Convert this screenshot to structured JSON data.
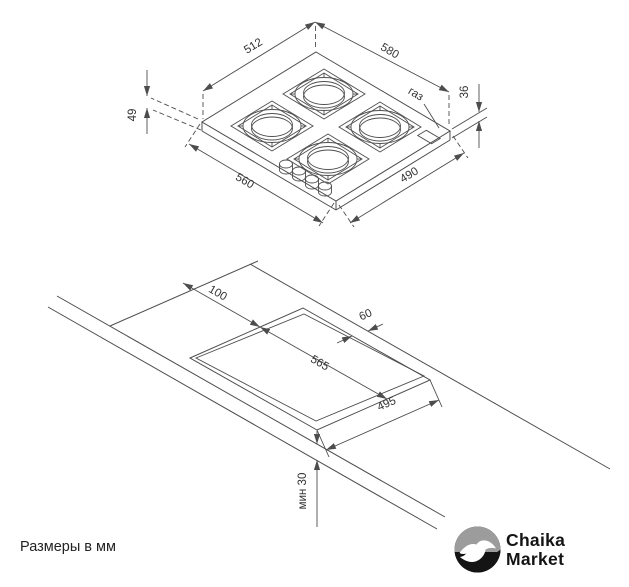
{
  "colors": {
    "background": "#ffffff",
    "line": "#4d4d4d",
    "text": "#333333",
    "logo_ink": "#141414",
    "logo_gray": "#9c9c9c"
  },
  "top_view": {
    "dim_back_left_edge": "512",
    "dim_back_right_edge": "580",
    "gas_connection_label": "газ",
    "dim_body_height": "36",
    "dim_total_height": "49",
    "dim_front_left_edge": "560",
    "dim_front_right_edge": "490"
  },
  "cutout_view": {
    "dim_side_clearance": "100",
    "dim_cutout_length": "565",
    "dim_back_clearance": "60",
    "dim_cutout_width": "495",
    "dim_min_front_clearance": "мин 30"
  },
  "footer": {
    "units_note": "Размеры в мм"
  },
  "logo": {
    "name_line1": "Chaika",
    "name_line2": "Market"
  }
}
